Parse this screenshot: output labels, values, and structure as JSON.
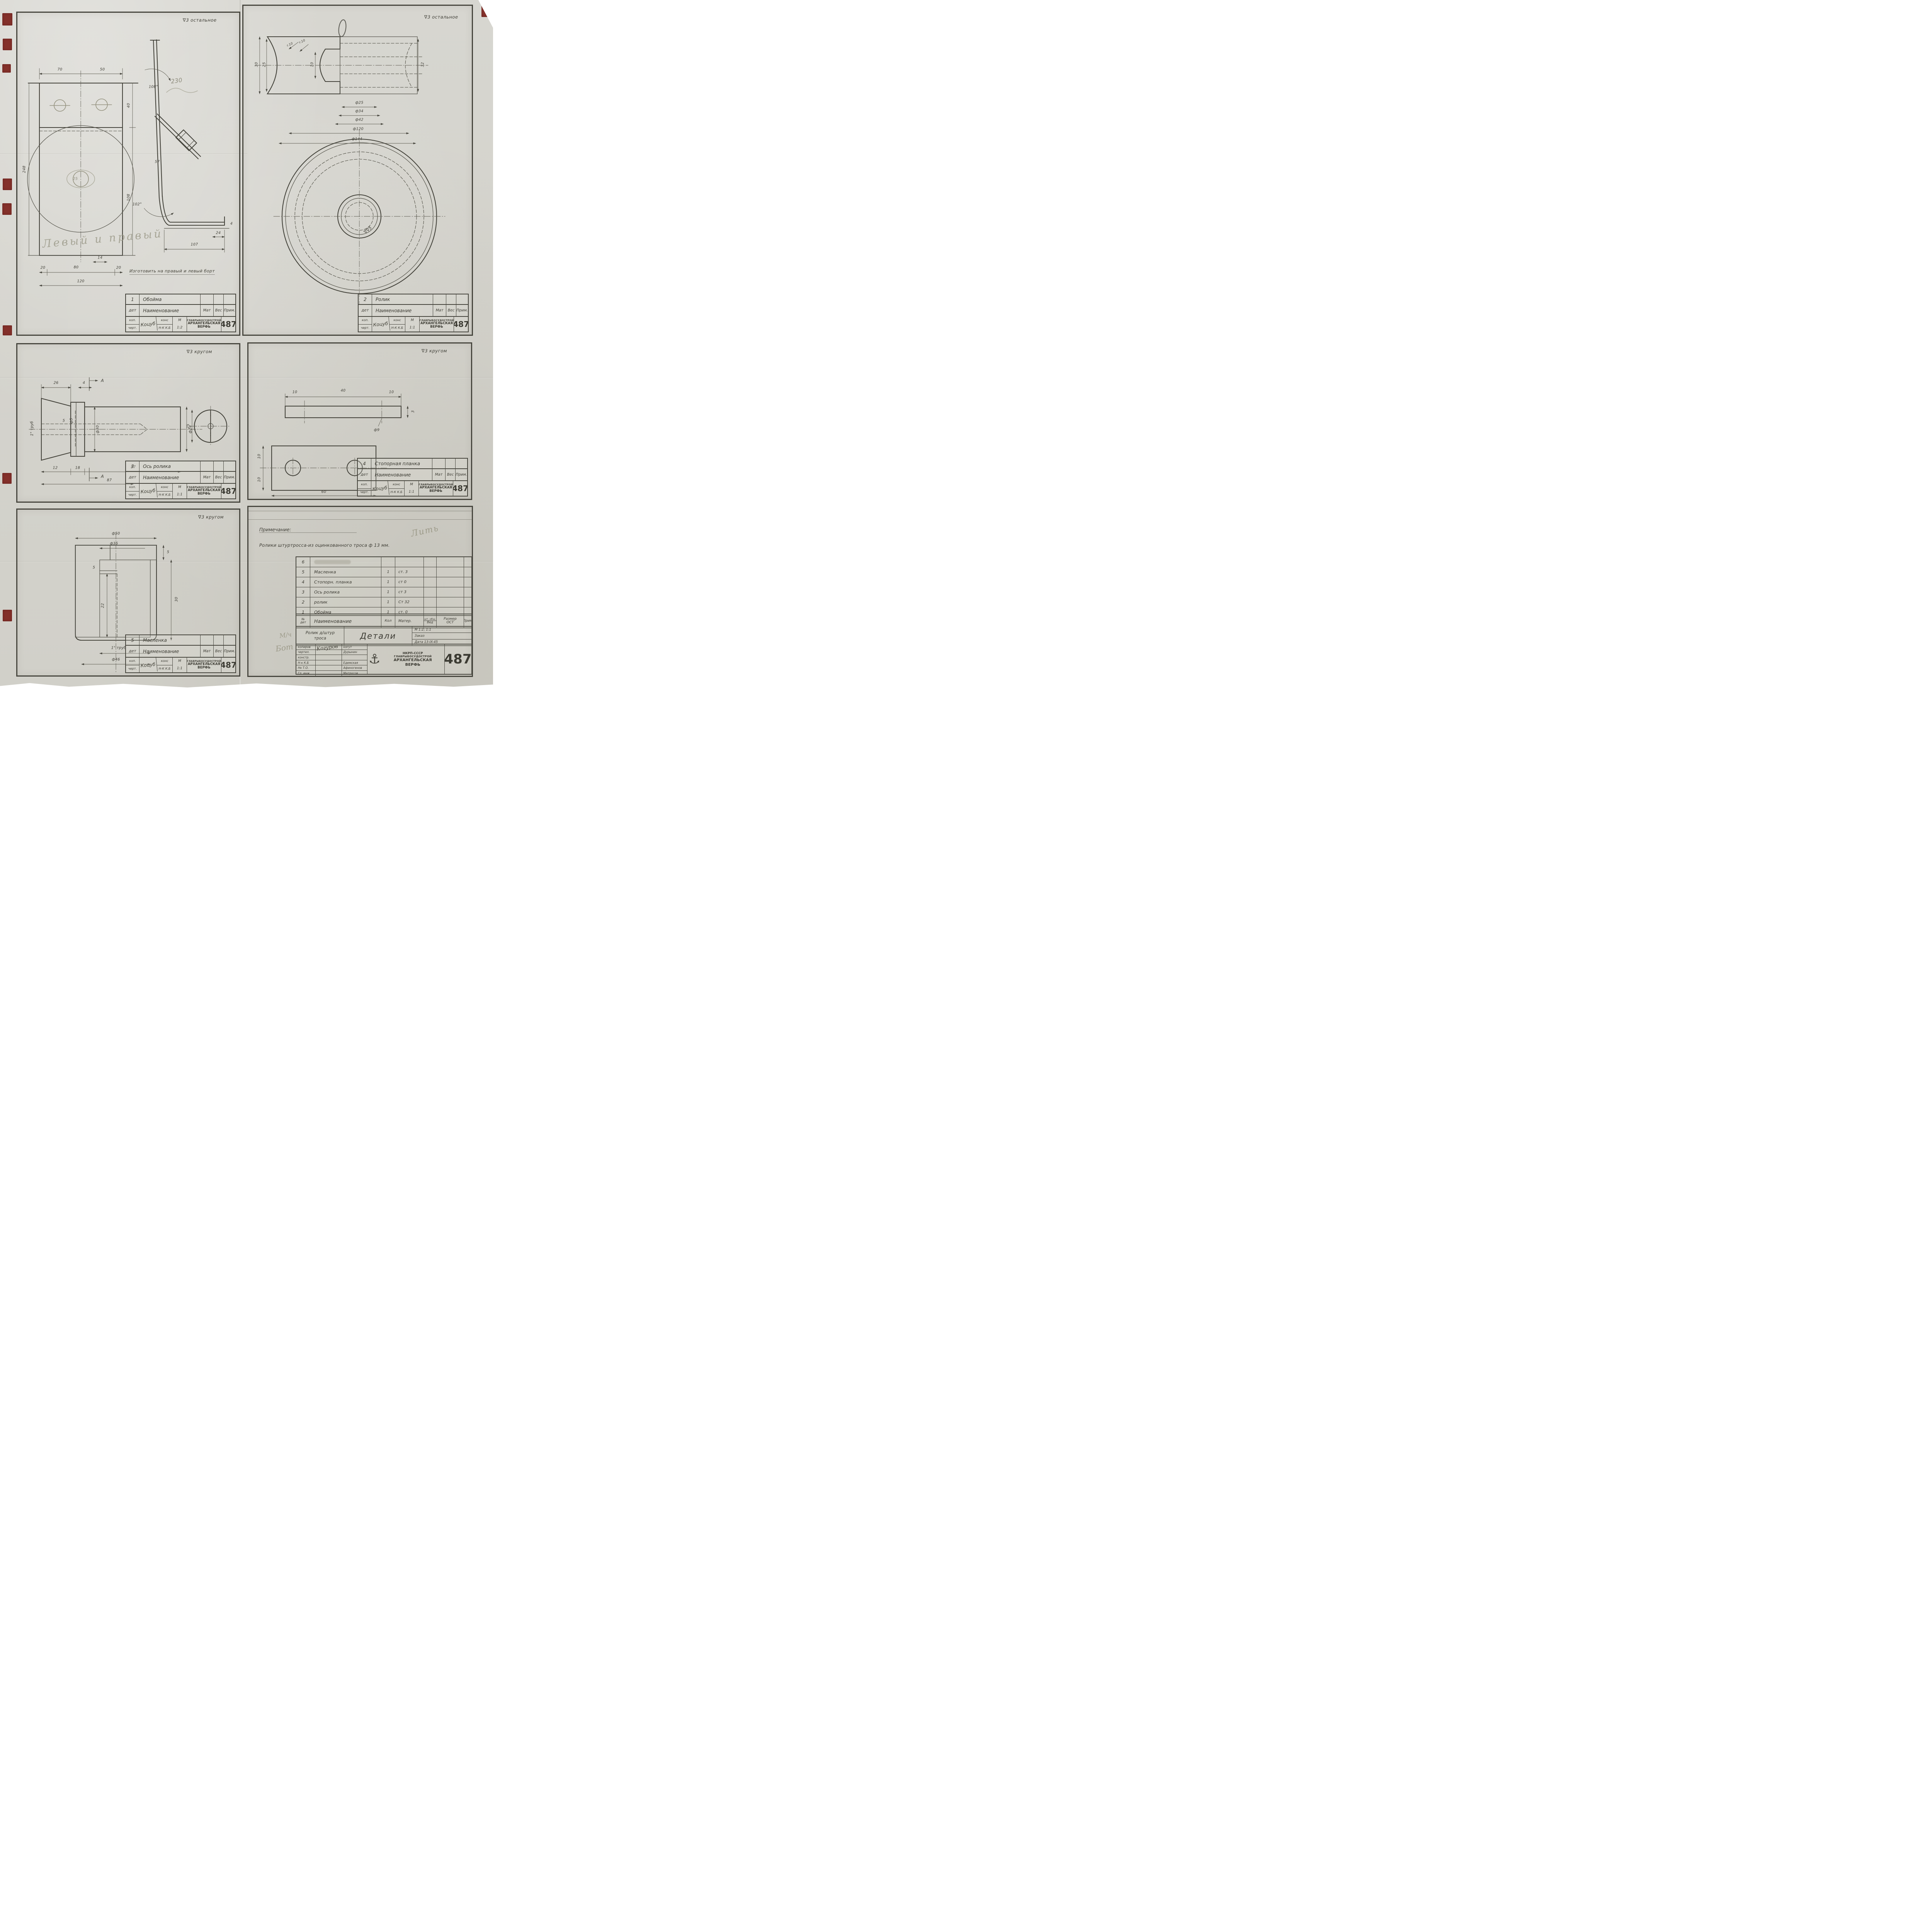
{
  "doc": {
    "number": "487",
    "agency": "НКРП-СССР",
    "org": "ГЛАВРЫБОСУДОСТРОЙ",
    "yard1": "АРХАНГЕЛЬСКАЯ",
    "yard2": "ВЕРФЬ"
  },
  "tb": {
    "col_det": "дет",
    "col_name": "Наименование",
    "col_mat": "Мат",
    "col_ves": "Вес",
    "col_prim": "Прим.",
    "row_kop": "коп.",
    "row_chert": "черт.",
    "sig": "Коцуб",
    "kons": "конс",
    "nk": "Н-К",
    "kb": "К.Б",
    "m": "М"
  },
  "panels": {
    "p1": {
      "finish": "∇3 остальное",
      "no": "1",
      "name": "Обойма",
      "scale": "1:2",
      "hand_pencil": "Левый и правый",
      "hand_ink": "Изготовить на правый и левый борт",
      "dims": {
        "d70": "70",
        "d50": "50",
        "d40": "40",
        "d108": "108",
        "d248": "248",
        "d14": "14",
        "d20a": "20",
        "d80": "80",
        "d20b": "20",
        "d120": "120",
        "a108": "108°",
        "a102": "102°",
        "d57": "57",
        "d24": "24",
        "d107": "107",
        "d4": "4",
        "p230": "230",
        "p25": "25"
      }
    },
    "p2": {
      "finish": "∇3 остальное",
      "no": "2",
      "name": "Ролик",
      "scale": "1:1",
      "dims": {
        "d30": "30",
        "d25": "25",
        "r10a": "r.10",
        "r10b": "r.10",
        "d10": "10",
        "d32": "32",
        "f25": "ф25",
        "f34": "ф34",
        "f42": "ф42",
        "f120": "ф120",
        "f144": "ф144",
        "mark": "∇∇5"
      }
    },
    "p3": {
      "finish": "∇3 кругом",
      "no": "3",
      "name": "Ось ролика",
      "scale": "1:1",
      "dims": {
        "d26": "26",
        "d4": "4",
        "secA": "А",
        "secA2": "А",
        "pipe": "1\" труб",
        "d5": "5",
        "f5": "ф5",
        "f30": "ф30",
        "f24": "ф24",
        "d12": "12",
        "d18": "18",
        "d57": "57",
        "d87": "87",
        "d25": "25"
      }
    },
    "p4": {
      "finish": "∇3 кругом",
      "no": "4",
      "name": "Стопорная планка",
      "scale": "1:1",
      "dims": {
        "d10a": "10",
        "d40": "40",
        "d10b": "10",
        "d3": "3",
        "f9": "ф9",
        "d10c": "10",
        "d10d": "10",
        "d60": "60"
      }
    },
    "p5": {
      "finish": "∇3 кругом",
      "no": "5",
      "name": "Масленка",
      "scale": "1:1",
      "dims": {
        "f50": "ф50",
        "f35": "ф35",
        "d5a": "5",
        "d5b": "5",
        "d30": "30",
        "d22": "22",
        "pipe": "1\" труб",
        "f46": "ф46"
      }
    },
    "p6": {
      "note_label": "Примечание:",
      "note_text": "Ролики штуртросса-из оцинкованного троса ф 13 мм.",
      "pencil_note": "Лить",
      "pencil_m1": "М/ч",
      "pencil_m2": "Бот",
      "table": {
        "h_no1": "№",
        "h_no2": "дет",
        "h_name": "Наименование",
        "h_qty": "Кол",
        "h_mat": "Матер.",
        "h_sht": "шт. общ.",
        "h_ved": "Вед",
        "h_size1": "Размер",
        "h_size2": "ОСТ",
        "h_prim": "Прим",
        "rows": [
          {
            "no": "6",
            "name": "",
            "qty": "",
            "mat": ""
          },
          {
            "no": "5",
            "name": "Масленка",
            "qty": "1",
            "mat": "ст. 3"
          },
          {
            "no": "4",
            "name": "Стопорн. планка",
            "qty": "1",
            "mat": "ст 0"
          },
          {
            "no": "3",
            "name": "Ось ролика",
            "qty": "1",
            "mat": "ст 3"
          },
          {
            "no": "2",
            "name": "ролик",
            "qty": "1",
            "mat": "Ст 32"
          },
          {
            "no": "1",
            "name": "Обойма",
            "qty": "1",
            "mat": "ст. 0"
          }
        ]
      },
      "title": {
        "object1": "Ролик д/штур",
        "object2": "троса",
        "sheet": "Детали",
        "scale": "М 1:2; 1:1",
        "order": "Заказ",
        "date": "Дата 13-IX-45"
      },
      "sign": {
        "roles": [
          "копиров",
          "чертил.",
          "констр.",
          "Н-к К.Б",
          "Нк Т.О.",
          "Гл. инж."
        ],
        "sig0": "Когуров",
        "names": [
          "когут",
          "Дурынин",
          "",
          "Едемская",
          "Афиногенов",
          "Матросов"
        ]
      }
    }
  }
}
